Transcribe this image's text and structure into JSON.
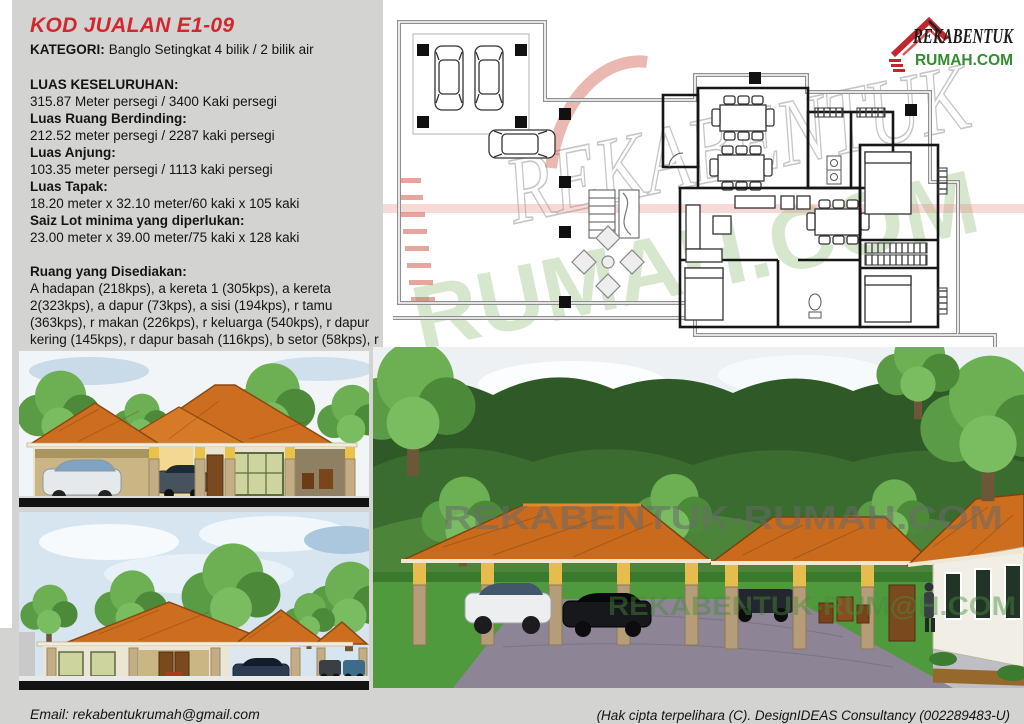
{
  "page": {
    "background": "#d3d3d1"
  },
  "colors": {
    "title_red": "#d1282e",
    "logo_green": "#2f8f2f",
    "logo_red": "#c2272d",
    "roof_orange": "#cd6d1f"
  },
  "info_panel": {
    "title": "KOD JUALAN E1-09",
    "category_label": "KATEGORI:",
    "category_value": "Banglo Setingkat 4 bilik / 2 bilik air",
    "specs": [
      {
        "label": "LUAS KESELURUHAN:",
        "value": "315.87 Meter persegi / 3400 Kaki persegi"
      },
      {
        "label": "Luas Ruang Berdinding:",
        "value": "212.52 meter persegi / 2287 kaki persegi"
      },
      {
        "label": "Luas Anjung:",
        "value": "103.35 meter persegi / 1113 kaki persegi"
      },
      {
        "label": "Luas Tapak:",
        "value": "18.20 meter x 32.10 meter/60 kaki x 105 kaki"
      },
      {
        "label": "Saiz Lot minima yang diperlukan:",
        "value": "23.00 meter x 39.00 meter/75 kaki x 128 kaki"
      }
    ],
    "rooms_label": "Ruang yang Disediakan:",
    "rooms_text": "A hadapan (218kps), a kereta 1 (305kps), a kereta 2(323kps), a dapur (73kps), a sisi (194kps), r tamu (363kps), r makan (226kps), r keluarga (540kps), r dapur kering (145kps), r dapur basah (116kps), b setor (58kps), r basuh (58kps), b tidur 1 (257kps), b tidur 2-3 (145kps), b tidur 4 (136kps) & b air 1-2 (48kps)"
  },
  "logo": {
    "title": "REKABENTUK",
    "subtitle": "RUMAH.COM"
  },
  "floor_plan": {
    "watermark_line1": "REKABENTUK",
    "watermark_line2": "RUMAH.COM"
  },
  "main_render": {
    "watermark_gray": "REKABENTUK-RUMAH.COM",
    "watermark_green": "REKABENTUK-RUM@H.COM"
  },
  "footer": {
    "email": "Email: rekabentukrumah@gmail.com",
    "copyright": "(Hak cipta terpelihara (C). DesignIDEAS Consultancy (002289483-U)"
  }
}
